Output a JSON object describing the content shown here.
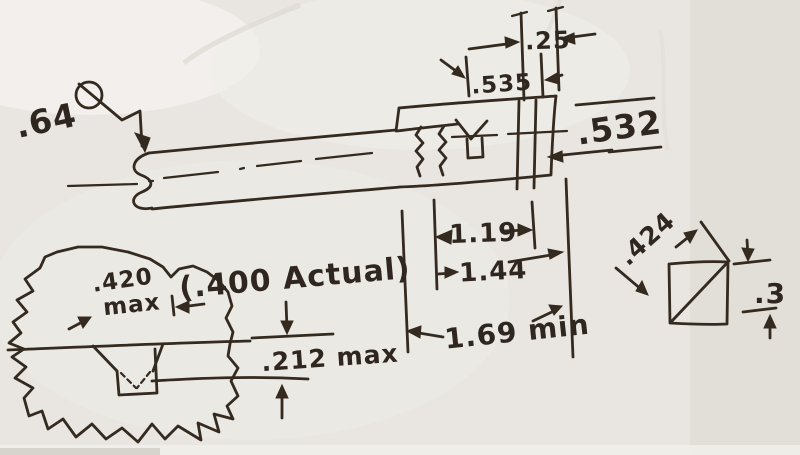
{
  "document": {
    "kind": "hand-drawn machining sketch (scanned pen on paper)",
    "paper_color": "#e9e6e1",
    "ink_color": "#342a1f"
  },
  "labels": {
    "left_diameter": ".64",
    "top_width_small": ".25",
    "top_width_groove": ".535",
    "right_diameter": ".532",
    "length_1": "1.19",
    "length_2": "1.44",
    "length_3": "1.69 min",
    "knob_width_value": ".420",
    "knob_width_qualifier": "max",
    "knob_actual": "(.400 Actual)",
    "slot_depth": ".212 max",
    "square_diagonal": ".424",
    "square_side": ".3"
  }
}
